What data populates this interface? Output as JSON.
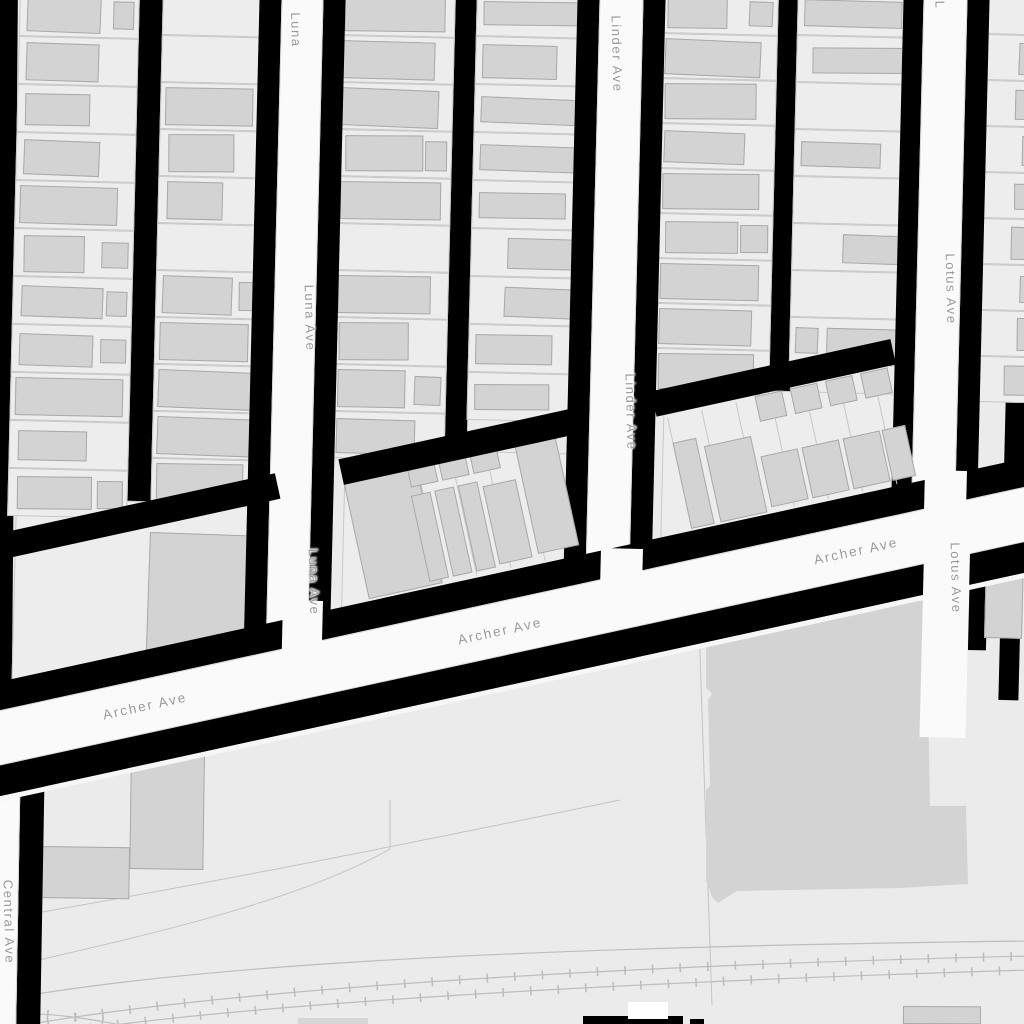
{
  "app": "street-map-view",
  "streets": [
    "Luna Ave",
    "Linder Ave",
    "Lotus Ave",
    "Archer Ave",
    "Central Ave"
  ],
  "colors": {
    "ground": "#ebebeb",
    "parcel": "#ededed",
    "parcel_line": "#c8c8c8",
    "building": "#d3d3d3",
    "building_line": "#a9a9a9",
    "street_fill": "#fafafa",
    "street_edge": "#d9d9d9",
    "alley_black": "#000000",
    "label_gray": "#989898",
    "rail_line": "#bdbdbd",
    "boundary_line": "#c4c4c4",
    "seam": "#f6f6f6",
    "white_shape": "#ffffff",
    "bottom_gray": "#d7d7d7"
  },
  "street_labels": [
    {
      "id": "luna-top",
      "text": "Luna",
      "x": 296,
      "y": 30,
      "rot": 88.6,
      "size": 13
    },
    {
      "id": "linder-top",
      "text": "Linder Ave",
      "x": 617,
      "y": 54,
      "rot": 88.6,
      "size": 13
    },
    {
      "id": "lotus-top",
      "text": "L",
      "x": 940,
      "y": 5,
      "rot": 88.6,
      "size": 13
    },
    {
      "id": "luna-mid",
      "text": "Luna Ave",
      "x": 310,
      "y": 318,
      "rot": 88.6,
      "size": 13
    },
    {
      "id": "linder-mid",
      "text": "Linder Ave",
      "x": 631,
      "y": 412,
      "rot": 88.6,
      "size": 13
    },
    {
      "id": "lotus-mid",
      "text": "Lotus Ave",
      "x": 951,
      "y": 289,
      "rot": 88.6,
      "size": 13
    },
    {
      "id": "luna-low",
      "text": "Luna Ave",
      "x": 314,
      "y": 582,
      "rot": 88.6,
      "size": 13
    },
    {
      "id": "lotus-low",
      "text": "Lotus Ave",
      "x": 956,
      "y": 578,
      "rot": 88.6,
      "size": 13
    },
    {
      "id": "archer-w",
      "text": "Archer Ave",
      "x": 145,
      "y": 706,
      "rot": -12.3,
      "size": 13.5
    },
    {
      "id": "archer-c",
      "text": "Archer Ave",
      "x": 500,
      "y": 631,
      "rot": -12.3,
      "size": 13.5
    },
    {
      "id": "archer-e",
      "text": "Archer Ave",
      "x": 856,
      "y": 551,
      "rot": -12.3,
      "size": 13.5
    },
    {
      "id": "central",
      "text": "Central Ave",
      "x": 9,
      "y": 922,
      "rot": 88.6,
      "size": 13
    }
  ],
  "geometry": {
    "section_parcels": [
      [
        16,
        498,
        278,
        198,
        1.4
      ],
      [
        345,
        448,
        252,
        190,
        1.4
      ],
      [
        664,
        388,
        260,
        172,
        1.4
      ]
    ],
    "columns": [
      {
        "id": "A1",
        "x": 20,
        "y": -12,
        "w": 120,
        "rot": 1.4,
        "lots": 11,
        "lotH": 48,
        "seed": 11,
        "style": "mixL"
      },
      {
        "id": "A2",
        "x": 163,
        "y": -12,
        "w": 108,
        "rot": 1.4,
        "lots": 11,
        "lotH": 47,
        "seed": 23,
        "style": "mixL"
      },
      {
        "id": "B1",
        "x": 340,
        "y": -12,
        "w": 116,
        "rot": 1.4,
        "lots": 10,
        "lotH": 47,
        "seed": 5,
        "style": "mixL"
      },
      {
        "id": "B2",
        "x": 477,
        "y": -12,
        "w": 122,
        "rot": 1.4,
        "lots": 9,
        "lotH": 48,
        "seed": 37,
        "style": "bars"
      },
      {
        "id": "C1",
        "x": 662,
        "y": -12,
        "w": 117,
        "rot": 1.4,
        "lots": 9,
        "lotH": 45,
        "seed": 51,
        "style": "mixL"
      },
      {
        "id": "C2",
        "x": 798,
        "y": -12,
        "w": 128,
        "rot": 1.4,
        "lots": 8,
        "lotH": 47,
        "seed": 8,
        "style": "bars"
      },
      {
        "id": "D",
        "x": 986,
        "y": -12,
        "w": 55,
        "rot": 1.4,
        "lots": 9,
        "lotH": 46,
        "seed": 19,
        "style": "edgeR"
      }
    ],
    "black_bands": [
      [
        -8,
        -16,
        26,
        706,
        0.5
      ],
      [
        139,
        -16,
        25,
        545,
        1.4
      ],
      [
        455,
        -16,
        23,
        492,
        1.4
      ],
      [
        778,
        -16,
        22,
        432,
        1.4
      ],
      [
        1006,
        388,
        20,
        312,
        1.4
      ],
      [
        906,
        572,
        18,
        135,
        1.4
      ],
      [
        970,
        565,
        18,
        85,
        1.4
      ],
      [
        583,
        1016,
        100,
        8,
        0
      ],
      [
        690,
        1019,
        14,
        5,
        0
      ]
    ],
    "special_buildings": [
      [
        150,
        532,
        142,
        128,
        2.0
      ],
      [
        131,
        749,
        74,
        120,
        0.8
      ],
      [
        38,
        846,
        92,
        52,
        0.8
      ],
      [
        986,
        556,
        38,
        82,
        1.4
      ],
      [
        903,
        1006,
        78,
        18,
        0.3
      ]
    ],
    "white_shapes": [
      [
        628,
        1002,
        40,
        17,
        0
      ]
    ],
    "gray_slivers": [
      [
        298,
        1018,
        70,
        6,
        0
      ]
    ],
    "big_building": {
      "x": 700,
      "y": 580,
      "w": 272,
      "h": 332,
      "points": "6,68 22,57 28,61 44,48 62,51 74,40 100,42 106,32 136,34 142,24 172,27 178,17 206,19 212,9 228,8 228,120 230,226 266,226 268,304 200,308 37,311 18,323 12,317 6,300 6,210 10,206 8,120 12,114 6,108"
    },
    "vertical_streets": [
      {
        "id": "luna",
        "black": [
          260,
          -20,
          86,
          675,
          1.4
        ],
        "white": [
          282,
          -20,
          42,
          668,
          1.4
        ]
      },
      {
        "id": "linder",
        "black": [
          578,
          -20,
          88,
          640,
          1.4
        ],
        "white": [
          600,
          -20,
          44,
          632,
          1.4
        ]
      },
      {
        "id": "lotus",
        "black": [
          904,
          -20,
          86,
          560,
          1.4
        ],
        "white": [
          924,
          -20,
          44,
          545,
          1.4
        ]
      },
      {
        "id": "central",
        "black": [
          22,
          692,
          24,
          345,
          1.0
        ],
        "white": [
          -22,
          692,
          44,
          345,
          1.0
        ]
      }
    ],
    "archer": {
      "x": -40,
      "y": 719,
      "rot": -12.3,
      "len": 1200,
      "upper_black_pieces": [
        [
          40,
          -173,
          320,
          26
        ],
        [
          425,
          -173,
          240,
          26
        ],
        [
          745,
          -173,
          245,
          26
        ]
      ],
      "dividers": [
        [
          430,
          -144,
          1,
          114
        ],
        [
          465,
          -144,
          1,
          114
        ],
        [
          500,
          -144,
          1,
          114
        ],
        [
          535,
          -144,
          1,
          114
        ],
        [
          570,
          -144,
          1,
          114
        ],
        [
          605,
          -144,
          1,
          114
        ],
        [
          755,
          -144,
          1,
          114
        ],
        [
          790,
          -144,
          1,
          114
        ],
        [
          825,
          -144,
          1,
          114
        ],
        [
          860,
          -144,
          1,
          114
        ],
        [
          895,
          -144,
          1,
          114
        ],
        [
          930,
          -144,
          1,
          114
        ],
        [
          965,
          -144,
          1,
          114
        ]
      ],
      "row_buildings": [
        [
          425,
          -150,
          75,
          120
        ],
        [
          490,
          -158,
          28,
          28
        ],
        [
          522,
          -158,
          28,
          28
        ],
        [
          554,
          -158,
          28,
          28
        ],
        [
          488,
          -122,
          20,
          88
        ],
        [
          512,
          -122,
          20,
          88
        ],
        [
          536,
          -122,
          20,
          88
        ],
        [
          560,
          -116,
          34,
          80
        ],
        [
          600,
          -150,
          42,
          112
        ],
        [
          755,
          -118,
          24,
          88
        ],
        [
          785,
          -108,
          48,
          78
        ],
        [
          845,
          -146,
          28,
          26
        ],
        [
          881,
          -146,
          28,
          26
        ],
        [
          917,
          -146,
          28,
          26
        ],
        [
          953,
          -146,
          28,
          26
        ],
        [
          838,
          -86,
          38,
          52
        ],
        [
          880,
          -86,
          38,
          52
        ],
        [
          922,
          -86,
          38,
          52
        ],
        [
          962,
          -86,
          24,
          52
        ]
      ],
      "north_black": [
        0,
        -28,
        1200,
        28
      ],
      "white": [
        0,
        0,
        1200,
        54
      ],
      "south_black": [
        0,
        54,
        1200,
        30
      ],
      "seam": [
        0,
        84,
        1200,
        5
      ]
    },
    "throat_patches": [
      [
        283,
        600,
        40,
        70,
        1.4
      ],
      [
        601,
        548,
        42,
        72,
        1.4
      ],
      [
        925,
        470,
        42,
        72,
        1.4
      ],
      [
        924,
        552,
        46,
        185,
        1.4
      ]
    ],
    "boundary_paths": [
      "M25,915 C180,888 330,860 620,800",
      "M30,962 C160,932 300,900 390,849",
      "M699,625 L712,1005",
      "M390,800 L390,849"
    ],
    "rail_plain": [
      "M-10,1002 C150,972 420,948 1030,941"
    ],
    "rail_ticked": [
      "M20,1026 C220,990 600,966 1030,956",
      "M90,1028 C300,1000 660,981 1030,970",
      "M-8,1016 C30,1010 80,1016 135,1028"
    ]
  }
}
